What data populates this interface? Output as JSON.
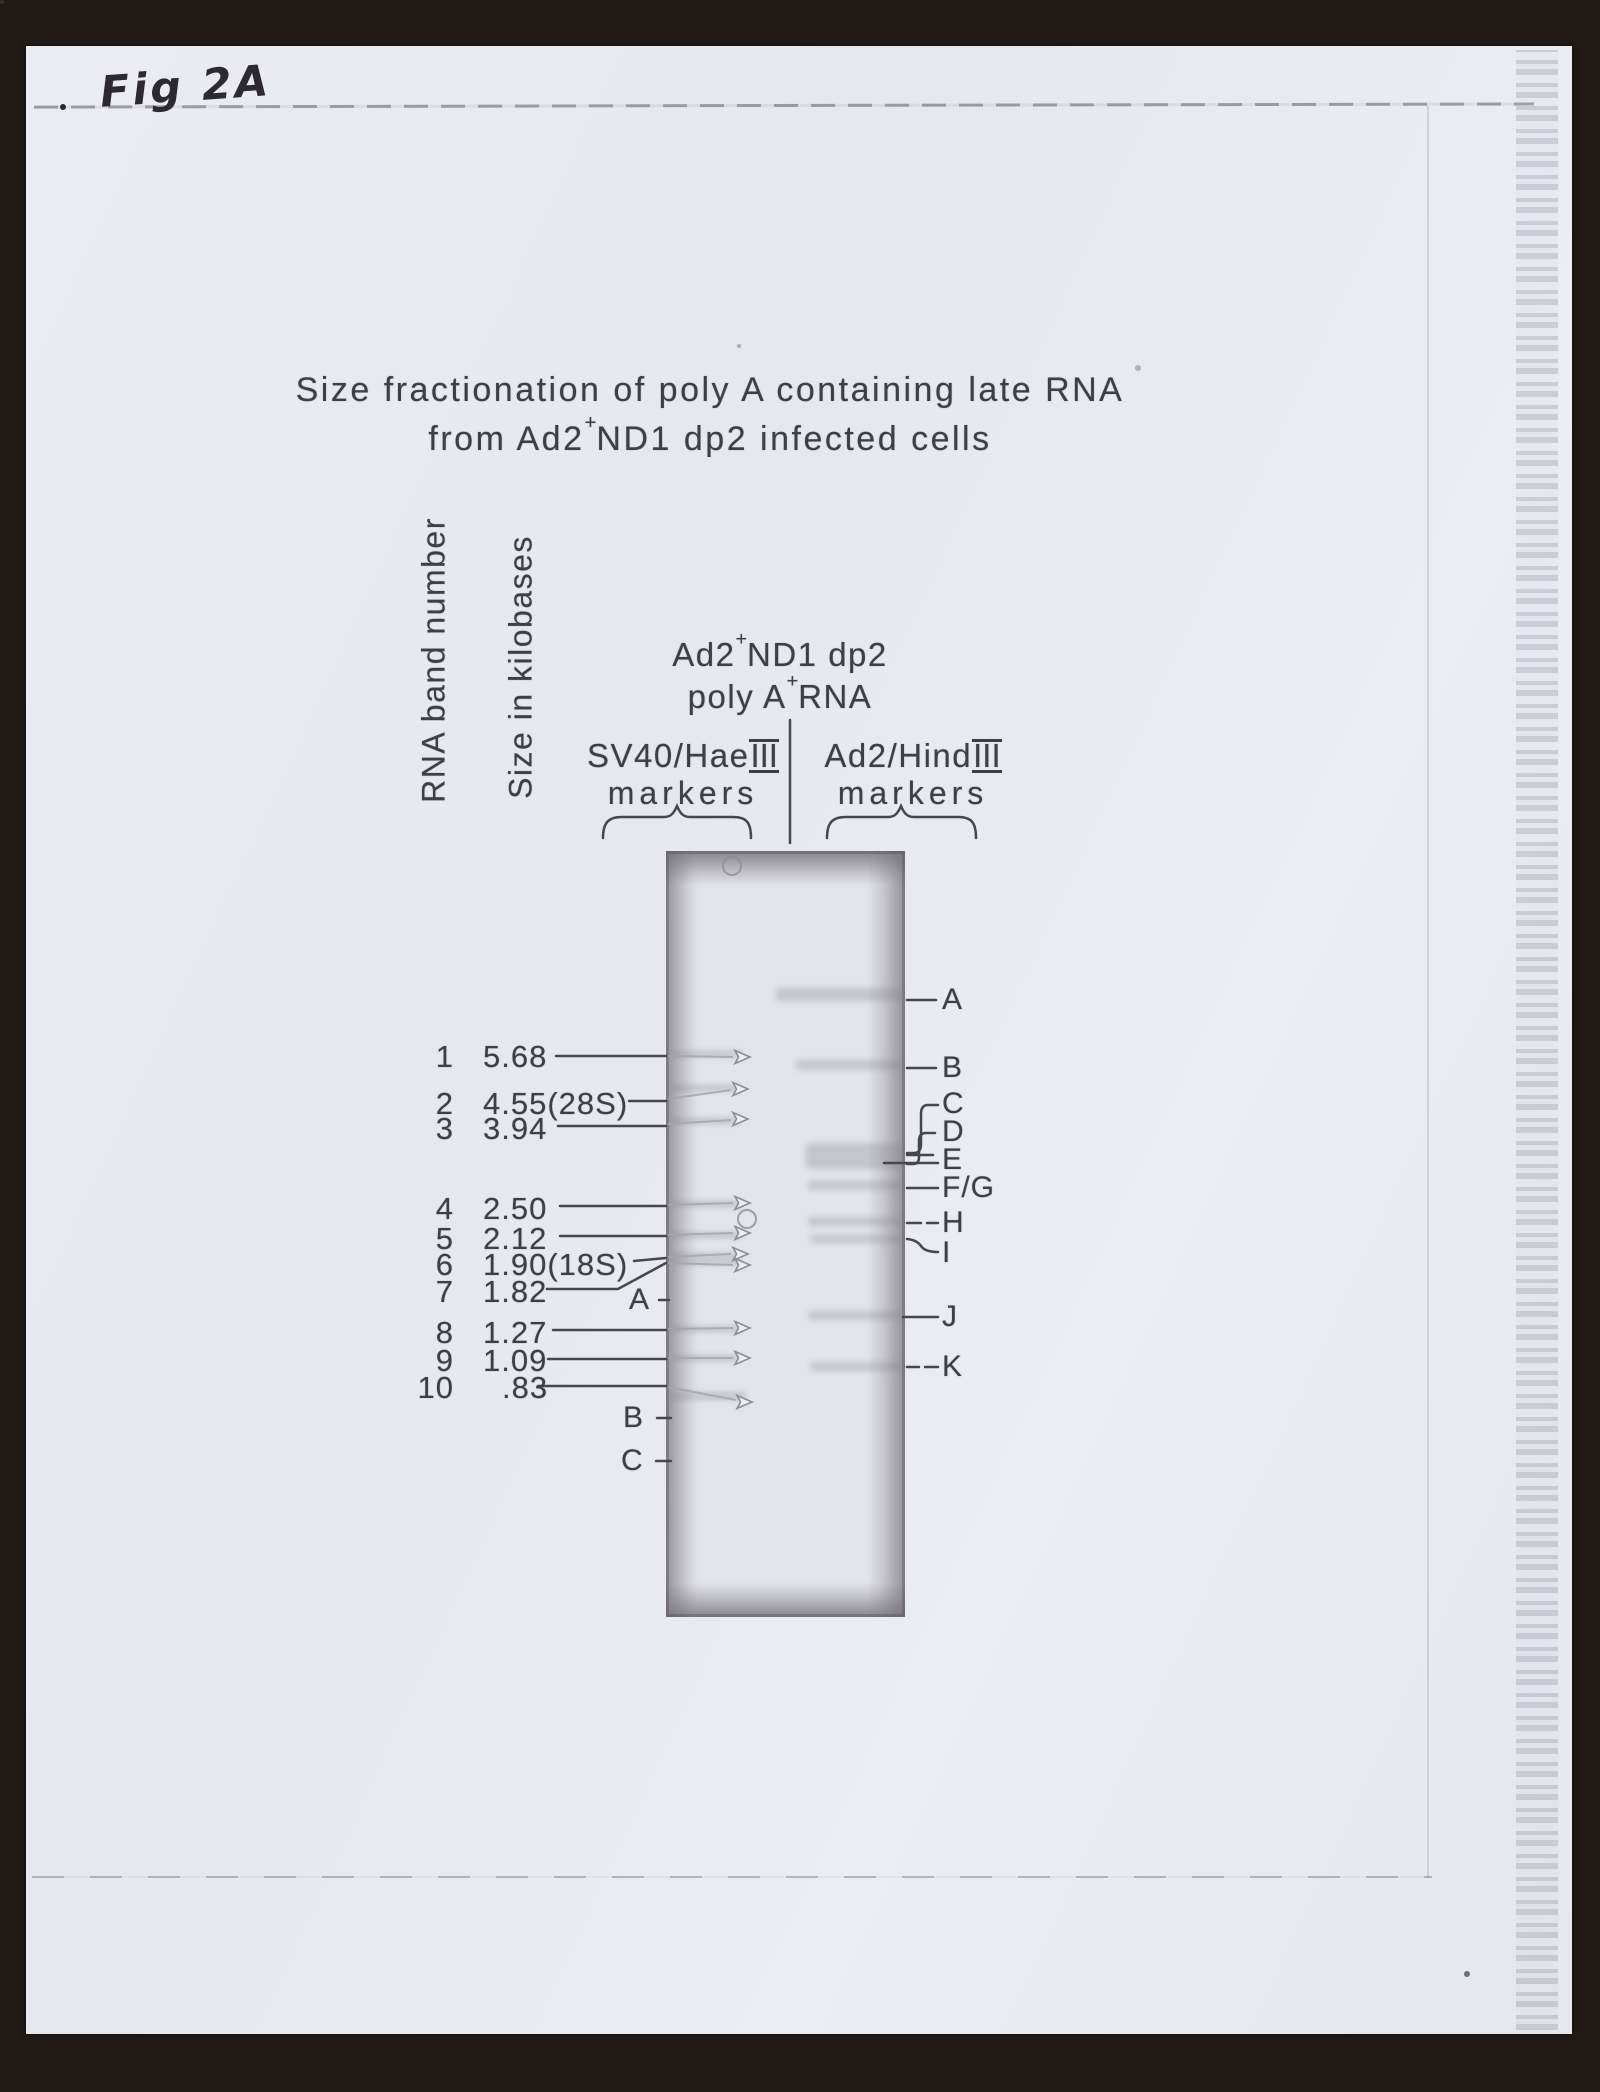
{
  "page": {
    "fig_label": "Fig 2A",
    "title_line1": "Size fractionation of poly A containing late RNA",
    "title_line2_pre": "from Ad2",
    "title_line2_sup": "+",
    "title_line2_post": "ND1 dp2 infected cells"
  },
  "figure": {
    "y_axis_label_1": "RNA band number",
    "y_axis_label_2": "Size in kilobases",
    "sample_header": {
      "line1_pre": "Ad2",
      "line1_sup": "+",
      "line1_post": "ND1 dp2",
      "line2_pre": "poly A",
      "line2_sup": "+",
      "line2_post": "RNA"
    },
    "left_lane": {
      "name_pre": "SV40/Hae",
      "name_roman": "III",
      "sub": "markers"
    },
    "right_lane": {
      "name_pre": "Ad2/Hind",
      "name_roman": "III",
      "sub": "markers"
    },
    "bands": [
      {
        "num": "1",
        "size": "5.68"
      },
      {
        "num": "2",
        "size": "4.55(28S)"
      },
      {
        "num": "3",
        "size": "3.94"
      },
      {
        "num": "4",
        "size": "2.50"
      },
      {
        "num": "5",
        "size": "2.12"
      },
      {
        "num": "6",
        "size": "1.90(18S)"
      },
      {
        "num": "7",
        "size": "1.82"
      },
      {
        "num": "8",
        "size": "1.27"
      },
      {
        "num": "9",
        "size": "1.09"
      },
      {
        "num": "10",
        "size": ".83"
      }
    ],
    "left_gel_labels": [
      "A",
      "B",
      "C"
    ],
    "right_gel_labels": [
      "A",
      "B",
      "C",
      "D",
      "E",
      "F/G",
      "H",
      "I",
      "J",
      "K"
    ],
    "colors": {
      "paper": "#e9ebf1",
      "ink": "#3e3e46",
      "scanner_background": "#221a16"
    }
  }
}
